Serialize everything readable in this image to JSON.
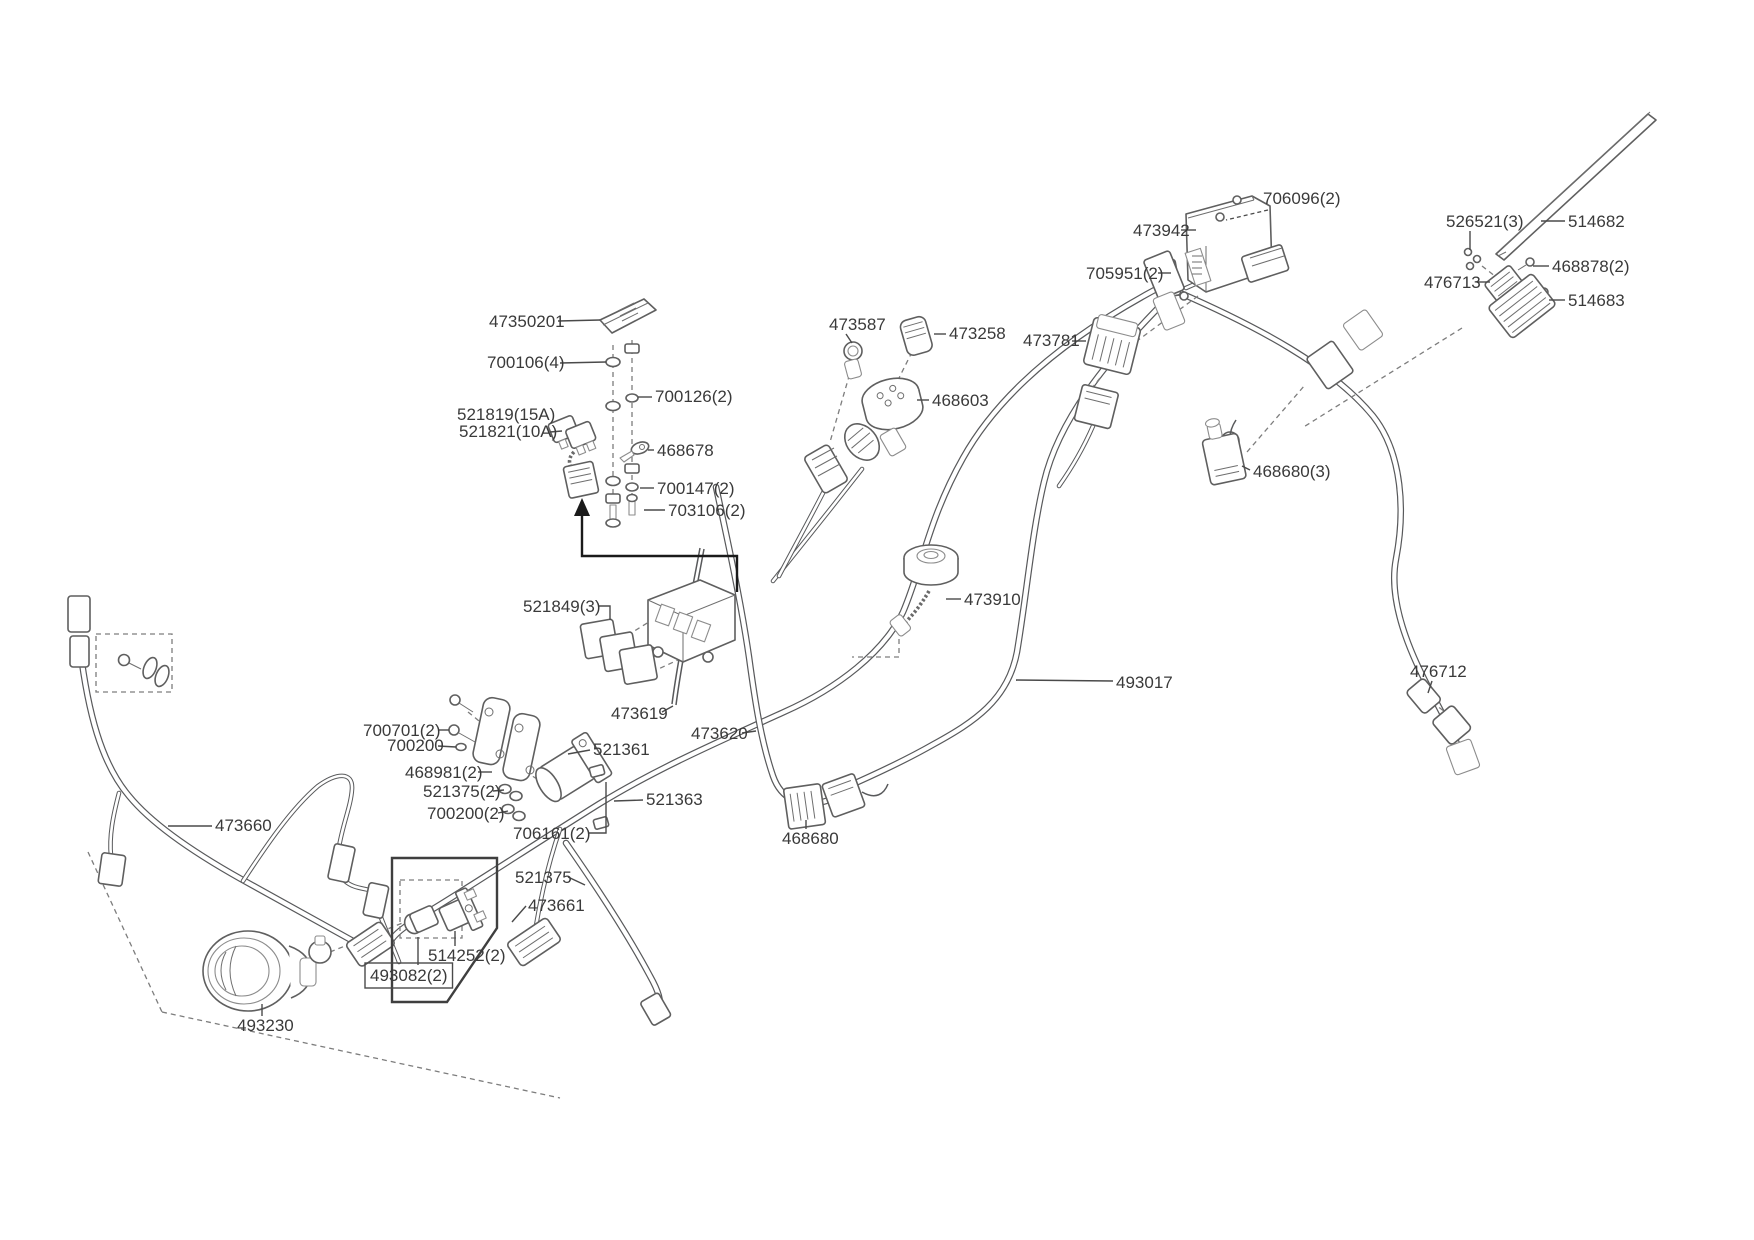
{
  "document": {
    "kind": "wiring-harness-parts-diagram",
    "background_color": "#ffffff",
    "wire_color": "#58595b",
    "label_color": "#3a3a3a"
  },
  "parts": [
    {
      "part_number": "47350201",
      "x": 489,
      "y": 327,
      "leader": [
        [
          558,
          321
        ],
        [
          600,
          320
        ]
      ]
    },
    {
      "part_number": "700106(4)",
      "x": 487,
      "y": 368,
      "leader": [
        [
          560,
          363
        ],
        [
          606,
          362
        ]
      ]
    },
    {
      "part_number": "700126(2)",
      "x": 655,
      "y": 402,
      "leader": [
        [
          638,
          397
        ],
        [
          652,
          397
        ]
      ]
    },
    {
      "part_number": "521819(15A)",
      "x": 457,
      "y": 420
    },
    {
      "part_number": "521821(10A)",
      "x": 459,
      "y": 437,
      "leader": [
        [
          550,
          432
        ],
        [
          562,
          431
        ]
      ]
    },
    {
      "part_number": "468678",
      "x": 657,
      "y": 456,
      "leader": [
        [
          648,
          450
        ],
        [
          654,
          450
        ]
      ]
    },
    {
      "part_number": "700147(2)",
      "x": 657,
      "y": 494,
      "leader": [
        [
          640,
          488
        ],
        [
          654,
          488
        ]
      ]
    },
    {
      "part_number": "703106(2)",
      "x": 668,
      "y": 516,
      "leader": [
        [
          644,
          510
        ],
        [
          665,
          510
        ]
      ]
    },
    {
      "part_number": "521849(3)",
      "x": 523,
      "y": 612,
      "leader": [
        [
          598,
          606
        ],
        [
          610,
          606
        ],
        [
          610,
          620
        ]
      ]
    },
    {
      "part_number": "473619",
      "x": 611,
      "y": 719,
      "leader": [
        [
          662,
          712
        ],
        [
          673,
          706
        ]
      ]
    },
    {
      "part_number": "473620",
      "x": 691,
      "y": 739,
      "leader": [
        [
          742,
          733
        ],
        [
          756,
          731
        ]
      ]
    },
    {
      "part_number": "521361",
      "x": 593,
      "y": 755,
      "leader": [
        [
          590,
          750
        ],
        [
          568,
          754
        ]
      ]
    },
    {
      "part_number": "700701(2)",
      "x": 363,
      "y": 736,
      "leader": [
        [
          438,
          730
        ],
        [
          449,
          730
        ]
      ]
    },
    {
      "part_number": "700200",
      "x": 387,
      "y": 751,
      "leader": [
        [
          438,
          746
        ],
        [
          456,
          747
        ]
      ]
    },
    {
      "part_number": "468981(2)",
      "x": 405,
      "y": 778,
      "leader": [
        [
          478,
          772
        ],
        [
          492,
          772
        ]
      ]
    },
    {
      "part_number": "521375(2)",
      "x": 423,
      "y": 797,
      "leader": [
        [
          493,
          791
        ],
        [
          504,
          790
        ]
      ]
    },
    {
      "part_number": "700200(2)",
      "x": 427,
      "y": 819,
      "leader": [
        [
          498,
          813
        ],
        [
          508,
          811
        ]
      ]
    },
    {
      "part_number": "706161(2)",
      "x": 513,
      "y": 839,
      "leader": [
        [
          588,
          833
        ],
        [
          606,
          833
        ],
        [
          606,
          782
        ]
      ]
    },
    {
      "part_number": "521375",
      "x": 515,
      "y": 883,
      "leader": [
        [
          568,
          877
        ],
        [
          585,
          885
        ]
      ]
    },
    {
      "part_number": "514252(2)",
      "x": 428,
      "y": 961,
      "leader": [
        [
          455,
          946
        ],
        [
          455,
          931
        ]
      ]
    },
    {
      "part_number": "493082(2)",
      "x": 370,
      "y": 981,
      "boxed": true,
      "leader": [
        [
          418,
          965
        ],
        [
          418,
          937
        ]
      ]
    },
    {
      "part_number": "493230",
      "x": 237,
      "y": 1031,
      "leader": [
        [
          262,
          1016
        ],
        [
          262,
          1004
        ]
      ]
    },
    {
      "part_number": "473661",
      "x": 528,
      "y": 911,
      "leader": [
        [
          526,
          906
        ],
        [
          512,
          922
        ]
      ]
    },
    {
      "part_number": "468680",
      "x": 782,
      "y": 844,
      "leader": [
        [
          806,
          829
        ],
        [
          806,
          820
        ]
      ]
    },
    {
      "part_number": "521363",
      "x": 646,
      "y": 805,
      "leader": [
        [
          643,
          800
        ],
        [
          614,
          801
        ]
      ]
    },
    {
      "part_number": "473660",
      "x": 215,
      "y": 831,
      "leader": [
        [
          212,
          826
        ],
        [
          168,
          826
        ]
      ]
    },
    {
      "part_number": "473587",
      "x": 829,
      "y": 330,
      "leader": [
        [
          846,
          334
        ],
        [
          852,
          343
        ]
      ]
    },
    {
      "part_number": "473258",
      "x": 949,
      "y": 339,
      "leader": [
        [
          946,
          334
        ],
        [
          934,
          334
        ]
      ]
    },
    {
      "part_number": "468603",
      "x": 932,
      "y": 406,
      "leader": [
        [
          929,
          400
        ],
        [
          917,
          400
        ]
      ]
    },
    {
      "part_number": "473781",
      "x": 1023,
      "y": 346,
      "leader": [
        [
          1072,
          341
        ],
        [
          1086,
          341
        ]
      ]
    },
    {
      "part_number": "473942",
      "x": 1133,
      "y": 236,
      "leader": [
        [
          1181,
          230
        ],
        [
          1196,
          230
        ]
      ]
    },
    {
      "part_number": "706096(2)",
      "x": 1263,
      "y": 204,
      "leader_dashed": true,
      "leader": [
        [
          1268,
          210
        ],
        [
          1226,
          220
        ]
      ]
    },
    {
      "part_number": "705951(2)",
      "x": 1086,
      "y": 279,
      "leader": [
        [
          1158,
          273
        ],
        [
          1171,
          273
        ]
      ]
    },
    {
      "part_number": "526521(3)",
      "x": 1446,
      "y": 227,
      "leader": [
        [
          1470,
          231
        ],
        [
          1470,
          250
        ]
      ]
    },
    {
      "part_number": "514682",
      "x": 1568,
      "y": 227,
      "leader": [
        [
          1565,
          221
        ],
        [
          1541,
          221
        ]
      ]
    },
    {
      "part_number": "468878(2)",
      "x": 1552,
      "y": 272,
      "leader": [
        [
          1549,
          266
        ],
        [
          1533,
          266
        ]
      ]
    },
    {
      "part_number": "476713",
      "x": 1424,
      "y": 288,
      "leader": [
        [
          1477,
          282
        ],
        [
          1490,
          282
        ]
      ]
    },
    {
      "part_number": "514683",
      "x": 1568,
      "y": 306,
      "leader": [
        [
          1565,
          300
        ],
        [
          1549,
          300
        ]
      ]
    },
    {
      "part_number": "468680(3)",
      "x": 1253,
      "y": 477,
      "leader": [
        [
          1250,
          470
        ],
        [
          1242,
          466
        ]
      ]
    },
    {
      "part_number": "473910",
      "x": 964,
      "y": 605,
      "leader": [
        [
          961,
          599
        ],
        [
          946,
          599
        ]
      ]
    },
    {
      "part_number": "493017",
      "x": 1116,
      "y": 688,
      "leader": [
        [
          1113,
          681
        ],
        [
          1016,
          680
        ]
      ]
    },
    {
      "part_number": "476712",
      "x": 1410,
      "y": 677,
      "leader": [
        [
          1432,
          681
        ],
        [
          1428,
          693
        ]
      ]
    }
  ]
}
